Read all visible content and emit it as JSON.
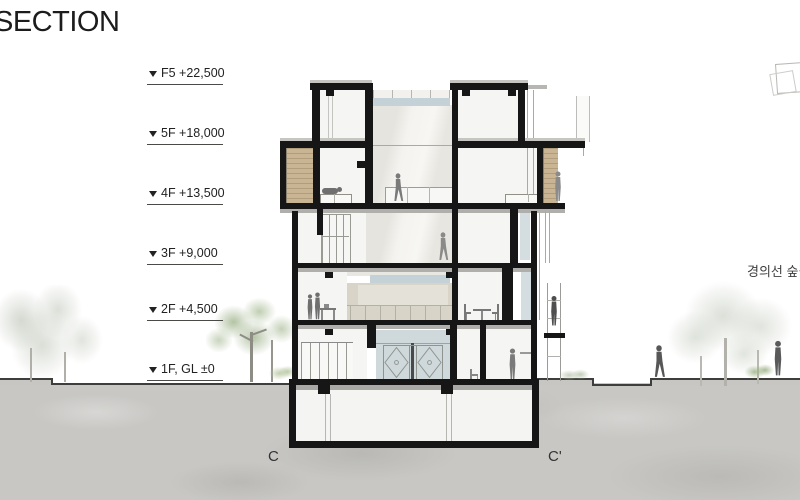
{
  "title": "SECTION",
  "levels": {
    "items": [
      {
        "label": "F5 +22,500"
      },
      {
        "label": "5F +18,000"
      },
      {
        "label": "4F +13,500"
      },
      {
        "label": "3F +9,000"
      },
      {
        "label": "2F +4,500"
      },
      {
        "label": "1F, GL ±0"
      }
    ]
  },
  "section_markers": {
    "start": "C",
    "end": "C'"
  },
  "annotations": {
    "site_label": "경의선 숲길"
  },
  "icons": {
    "level_marker": "triangle-down-icon",
    "key_plan": "key-plan-icon"
  },
  "colors": {
    "ink": "#161616",
    "wood": "#c9b493",
    "glazing": "#cfd9dc",
    "clerestory": "#c4d2d8",
    "ground": "#c8c7c4",
    "foliage": "#a8bf92"
  }
}
